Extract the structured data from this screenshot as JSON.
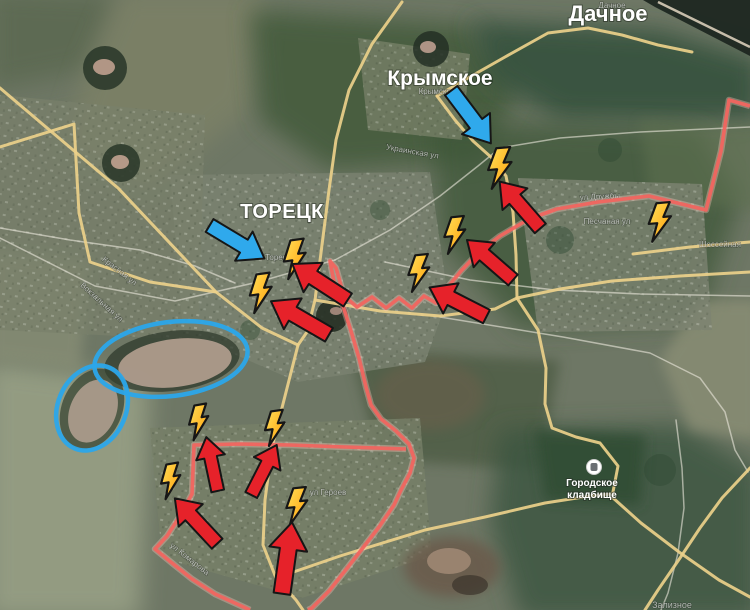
{
  "map": {
    "width": 750,
    "height": 610,
    "place_labels": {
      "dachnoe": "Дачное",
      "krymskoe": "Крымское",
      "toretsk": "ТОРЕЦК",
      "cemetery_line1": "Городское",
      "cemetery_line2": "кладбище"
    },
    "street_labels": [
      {
        "text": "Дачное",
        "x": 612,
        "y": 8,
        "rot": 0,
        "size": 8
      },
      {
        "text": "Крымское",
        "x": 437,
        "y": 94,
        "rot": 0,
        "size": 8
      },
      {
        "text": "Торецк",
        "x": 278,
        "y": 260,
        "rot": 0,
        "size": 8
      },
      {
        "text": "ул Дружбы",
        "x": 600,
        "y": 199,
        "rot": -3,
        "size": 8
      },
      {
        "text": "Песчаная ул",
        "x": 607,
        "y": 224,
        "rot": 0,
        "size": 8
      },
      {
        "text": "Шоссейная",
        "x": 720,
        "y": 247,
        "rot": 0,
        "size": 8
      },
      {
        "text": "Украинская ул",
        "x": 412,
        "y": 154,
        "rot": 10,
        "size": 8
      },
      {
        "text": "Красная ул",
        "x": 118,
        "y": 273,
        "rot": 38,
        "size": 8
      },
      {
        "text": "Вокзальная ул",
        "x": 100,
        "y": 304,
        "rot": 42,
        "size": 8
      },
      {
        "text": "ул Героев",
        "x": 328,
        "y": 495,
        "rot": 0,
        "size": 8
      },
      {
        "text": "ул Комарова",
        "x": 188,
        "y": 561,
        "rot": 38,
        "size": 8
      },
      {
        "text": "Зализное",
        "x": 672,
        "y": 608,
        "rot": 0,
        "size": 9
      }
    ],
    "roads": {
      "yellow": {
        "color": "#ecd08a",
        "paths": [
          [
            [
              0,
              88
            ],
            [
              40,
              122
            ],
            [
              118,
              188
            ],
            [
              216,
              292
            ],
            [
              262,
              328
            ],
            [
              298,
              345
            ]
          ],
          [
            [
              0,
              147
            ],
            [
              74,
              124
            ],
            [
              79,
              213
            ],
            [
              90,
              262
            ],
            [
              150,
              282
            ],
            [
              216,
              292
            ]
          ],
          [
            [
              402,
              2
            ],
            [
              372,
              44
            ],
            [
              349,
              90
            ],
            [
              336,
              140
            ],
            [
              329,
              190
            ],
            [
              322,
              245
            ],
            [
              315,
              300
            ],
            [
              307,
              332
            ],
            [
              298,
              345
            ]
          ],
          [
            [
              298,
              345
            ],
            [
              284,
              400
            ],
            [
              272,
              447
            ],
            [
              265,
              500
            ],
            [
              263,
              545
            ],
            [
              276,
              578
            ],
            [
              296,
              600
            ],
            [
              303,
              610
            ]
          ],
          [
            [
              315,
              300
            ],
            [
              380,
              311
            ],
            [
              440,
              316
            ],
            [
              495,
              309
            ],
            [
              517,
              298
            ],
            [
              560,
              289
            ],
            [
              612,
              281
            ],
            [
              680,
              276
            ],
            [
              750,
              272
            ]
          ],
          [
            [
              437,
              96
            ],
            [
              468,
              78
            ],
            [
              505,
              57
            ],
            [
              548,
              33
            ],
            [
              588,
              28
            ],
            [
              622,
              35
            ],
            [
              658,
              45
            ],
            [
              692,
              52
            ]
          ],
          [
            [
              437,
              96
            ],
            [
              455,
              120
            ],
            [
              473,
              141
            ],
            [
              492,
              158
            ],
            [
              506,
              176
            ],
            [
              513,
              212
            ],
            [
              516,
              255
            ],
            [
              517,
              298
            ]
          ],
          [
            [
              517,
              298
            ],
            [
              538,
              330
            ],
            [
              546,
              368
            ],
            [
              545,
              404
            ],
            [
              552,
              428
            ],
            [
              576,
              437
            ],
            [
              600,
              443
            ],
            [
              618,
              466
            ],
            [
              612,
              497
            ],
            [
              641,
              523
            ],
            [
              679,
              552
            ],
            [
              719,
              580
            ],
            [
              750,
              597
            ]
          ],
          [
            [
              750,
              468
            ],
            [
              722,
              498
            ],
            [
              700,
              528
            ],
            [
              680,
              558
            ],
            [
              658,
              590
            ],
            [
              645,
              610
            ]
          ],
          [
            [
              633,
              254
            ],
            [
              690,
              247
            ],
            [
              750,
              242
            ]
          ],
          [
            [
              276,
              578
            ],
            [
              340,
              556
            ],
            [
              425,
              530
            ],
            [
              485,
              517
            ],
            [
              545,
              503
            ],
            [
              590,
              496
            ],
            [
              612,
              494
            ]
          ]
        ]
      },
      "white": {
        "color": "#eceade",
        "paths": [
          [
            [
              0,
              238
            ],
            [
              95,
              286
            ],
            [
              175,
              301
            ],
            [
              258,
              282
            ],
            [
              335,
              260
            ]
          ],
          [
            [
              335,
              260
            ],
            [
              390,
              230
            ],
            [
              440,
              196
            ],
            [
              478,
              166
            ],
            [
              500,
              148
            ],
            [
              560,
              138
            ],
            [
              640,
              132
            ],
            [
              750,
              127
            ]
          ],
          [
            [
              385,
              262
            ],
            [
              470,
              280
            ],
            [
              555,
              290
            ],
            [
              640,
              294
            ],
            [
              750,
              296
            ]
          ],
          [
            [
              440,
              317
            ],
            [
              520,
              330
            ],
            [
              563,
              337
            ],
            [
              650,
              353
            ],
            [
              700,
              378
            ],
            [
              725,
              412
            ],
            [
              735,
              450
            ],
            [
              748,
              472
            ]
          ],
          [
            [
              676,
              420
            ],
            [
              682,
              468
            ],
            [
              684,
              508
            ],
            [
              678,
              553
            ],
            [
              668,
              593
            ],
            [
              661,
              610
            ]
          ],
          [
            [
              0,
              228
            ],
            [
              70,
              240
            ],
            [
              140,
              250
            ],
            [
              195,
              266
            ],
            [
              235,
              283
            ]
          ]
        ]
      }
    },
    "annotations": {
      "front_line": {
        "color": "#f1655f",
        "halo": "#ffc9bd",
        "paths": [
          [
            [
              750,
              106
            ],
            [
              729,
              100
            ],
            [
              721,
              151
            ],
            [
              706,
              210
            ],
            [
              649,
              196
            ],
            [
              598,
              202
            ],
            [
              557,
              209
            ],
            [
              529,
              219
            ],
            [
              500,
              236
            ],
            [
              478,
              253
            ],
            [
              461,
              271
            ],
            [
              447,
              288
            ],
            [
              436,
              303
            ],
            [
              424,
              296
            ],
            [
              412,
              308
            ],
            [
              399,
              298
            ],
            [
              386,
              308
            ],
            [
              372,
              297
            ],
            [
              357,
              307
            ],
            [
              344,
              296
            ],
            [
              336,
              268
            ],
            [
              330,
              261
            ],
            [
              335,
              287
            ],
            [
              343,
              306
            ],
            [
              351,
              331
            ],
            [
              359,
              358
            ],
            [
              366,
              387
            ],
            [
              371,
              405
            ],
            [
              381,
              419
            ],
            [
              396,
              431
            ],
            [
              409,
              444
            ],
            [
              414,
              458
            ],
            [
              410,
              473
            ],
            [
              401,
              490
            ],
            [
              394,
              505
            ],
            [
              379,
              527
            ],
            [
              362,
              549
            ],
            [
              348,
              567
            ],
            [
              329,
              591
            ],
            [
              312,
              608
            ],
            [
              308,
              610
            ]
          ],
          [
            [
              406,
              449
            ],
            [
              345,
              447
            ],
            [
              290,
              445
            ],
            [
              240,
              444
            ],
            [
              194,
              445
            ],
            [
              193,
              470
            ],
            [
              192,
              494
            ],
            [
              180,
              516
            ],
            [
              167,
              536
            ],
            [
              155,
              549
            ],
            [
              172,
              563
            ],
            [
              192,
              579
            ],
            [
              215,
              594
            ],
            [
              237,
              604
            ],
            [
              250,
              610
            ]
          ]
        ]
      },
      "red_arrows": {
        "fill": "#e6222a",
        "outline": "#161616",
        "items": [
          {
            "x": 520,
            "y": 205,
            "angle": -131,
            "len": 62
          },
          {
            "x": 490,
            "y": 260,
            "angle": -139,
            "len": 61
          },
          {
            "x": 458,
            "y": 302,
            "angle": -153,
            "len": 64
          },
          {
            "x": 320,
            "y": 282,
            "angle": -147,
            "len": 66
          },
          {
            "x": 300,
            "y": 318,
            "angle": -150,
            "len": 67
          },
          {
            "x": 212,
            "y": 464,
            "angle": -102,
            "len": 55
          },
          {
            "x": 264,
            "y": 470,
            "angle": -63,
            "len": 56
          },
          {
            "x": 196,
            "y": 521,
            "angle": -133,
            "len": 62
          },
          {
            "x": 287,
            "y": 558,
            "angle": -82,
            "len": 72
          }
        ]
      },
      "blue_arrows": {
        "fill": "#2fa9ec",
        "outline": "#161616",
        "items": [
          {
            "x": 471,
            "y": 117,
            "angle": 53,
            "len": 66
          },
          {
            "x": 237,
            "y": 242,
            "angle": 31,
            "len": 64
          }
        ]
      },
      "bolts": {
        "fill_light": "#ffe35e",
        "fill_dark": "#ff9b04",
        "outline": "#161616",
        "items": [
          {
            "x": 500,
            "y": 168,
            "angle": -5,
            "scale": 1.0
          },
          {
            "x": 295,
            "y": 259,
            "angle": -8,
            "scale": 0.95
          },
          {
            "x": 261,
            "y": 293,
            "angle": -8,
            "scale": 0.95
          },
          {
            "x": 455,
            "y": 235,
            "angle": -6,
            "scale": 0.9
          },
          {
            "x": 419,
            "y": 273,
            "angle": -6,
            "scale": 0.9
          },
          {
            "x": 660,
            "y": 222,
            "angle": -5,
            "scale": 0.95
          },
          {
            "x": 199,
            "y": 422,
            "angle": -10,
            "scale": 0.85
          },
          {
            "x": 275,
            "y": 428,
            "angle": -8,
            "scale": 0.85
          },
          {
            "x": 171,
            "y": 481,
            "angle": -10,
            "scale": 0.85
          },
          {
            "x": 297,
            "y": 506,
            "angle": -6,
            "scale": 0.9
          }
        ]
      },
      "ellipses": {
        "color": "#2ba6ea",
        "items": [
          {
            "cx": 171,
            "cy": 359,
            "rx": 77,
            "ry": 37,
            "rot": -7
          },
          {
            "cx": 92,
            "cy": 408,
            "rx": 34,
            "ry": 44,
            "rot": 24
          }
        ]
      }
    }
  }
}
